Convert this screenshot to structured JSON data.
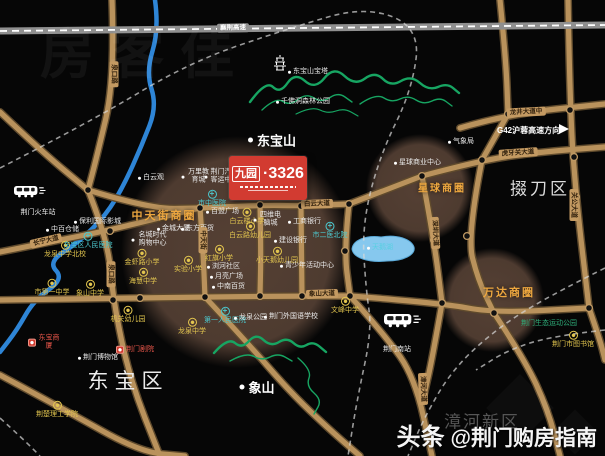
{
  "project": {
    "brand": "九园",
    "number": "·3326"
  },
  "g42": {
    "label": "G42沪蓉高速方向"
  },
  "watermarks": {
    "corner": "房客佳",
    "bottom_prefix": "头条",
    "bottom_handle": "@荆门购房指南"
  },
  "colors": {
    "road": "#b9925c",
    "road_casing": "#5f4a2c",
    "highway": "#8f8f8f",
    "river": "#2e85d6",
    "lake": "#86c8ee",
    "mountain": "#17a562",
    "circle": "#96705a",
    "rail": "#d8d8d8",
    "junction_ring": "#c09a64",
    "school": "#e3c64f",
    "hospital": "#4cc8ce",
    "red": "#e8564a",
    "zone": "#eda73f",
    "green": "#2fae7a",
    "teal": "#58cfe2",
    "badge": "#d23b31"
  },
  "districts": [
    {
      "label": "东宝区",
      "x": 128,
      "y": 380,
      "size": 21,
      "ls": 6,
      "color": "#ececec"
    },
    {
      "label": "掇刀区",
      "x": 540,
      "y": 187,
      "size": 17,
      "ls": 3,
      "color": "#dcdcdc"
    },
    {
      "label": "漳河新区",
      "x": 482,
      "y": 420,
      "size": 17,
      "ls": 2,
      "color": "#565656"
    }
  ],
  "peaks": [
    {
      "label": "东宝山",
      "x": 272,
      "y": 140
    },
    {
      "label": "象山",
      "x": 257,
      "y": 387
    }
  ],
  "zones": [
    {
      "label": "中天街商圈",
      "x": 164,
      "y": 215,
      "size": 11
    },
    {
      "label": "星球商圈",
      "x": 442,
      "y": 187,
      "size": 10
    },
    {
      "label": "万达商圈",
      "x": 509,
      "y": 292,
      "size": 11
    }
  ],
  "road_labels": [
    {
      "label": "襄荆高速",
      "x": 233,
      "y": 28,
      "rot": -1,
      "hw": true
    },
    {
      "label": "泉口路",
      "x": 114,
      "y": 74,
      "rot": 90
    },
    {
      "label": "泉口路",
      "x": 111,
      "y": 274,
      "rot": 90
    },
    {
      "label": "长宁大道",
      "x": 46,
      "y": 241,
      "rot": -13
    },
    {
      "label": "白云大道",
      "x": 317,
      "y": 204,
      "rot": -2
    },
    {
      "label": "中天街",
      "x": 203,
      "y": 240,
      "rot": 90
    },
    {
      "label": "象山大道",
      "x": 322,
      "y": 294,
      "rot": -2
    },
    {
      "label": "龙井大道中",
      "x": 526,
      "y": 112,
      "rot": -3
    },
    {
      "label": "虎牙关大道",
      "x": 518,
      "y": 153,
      "rot": -4
    },
    {
      "label": "关公大道",
      "x": 574,
      "y": 205,
      "rot": 90
    },
    {
      "label": "深圳大道",
      "x": 435,
      "y": 233,
      "rot": 87
    },
    {
      "label": "漳河大道",
      "x": 423,
      "y": 389,
      "rot": 88
    }
  ],
  "pois": [
    {
      "label": "龙泉中学北校",
      "k": "sch",
      "x": 65,
      "y": 250
    },
    {
      "label": "市第一中学",
      "k": "sch",
      "x": 52,
      "y": 288
    },
    {
      "label": "象山中学",
      "k": "sch",
      "x": 90,
      "y": 289
    },
    {
      "label": "金虾路小学",
      "k": "sch",
      "x": 142,
      "y": 258
    },
    {
      "label": "海慧中学",
      "k": "sch",
      "x": 143,
      "y": 277
    },
    {
      "label": "实验小学",
      "k": "sch",
      "x": 188,
      "y": 265
    },
    {
      "label": "红旗小学",
      "k": "sch",
      "x": 219,
      "y": 254
    },
    {
      "label": "白云楼小学",
      "k": "sch",
      "x": 247,
      "y": 217
    },
    {
      "label": "白云路幼儿园",
      "k": "sch",
      "x": 250,
      "y": 231
    },
    {
      "label": "小天鹅幼儿园",
      "k": "sch",
      "x": 277,
      "y": 256
    },
    {
      "label": "机关幼儿园",
      "k": "sch",
      "x": 128,
      "y": 315
    },
    {
      "label": "龙泉中学",
      "k": "sch",
      "x": 192,
      "y": 327
    },
    {
      "label": "文峰中学",
      "k": "sch",
      "x": 345,
      "y": 306
    },
    {
      "label": "荆楚理工学院",
      "k": "sch",
      "x": 57,
      "y": 410
    },
    {
      "label": "荆门市图书馆",
      "k": "sch",
      "x": 573,
      "y": 340
    },
    {
      "label": "东宝区人民医院",
      "k": "hos",
      "x": 88,
      "y": 241
    },
    {
      "label": "市中医院",
      "k": "hos",
      "x": 212,
      "y": 199
    },
    {
      "label": "第一人民医院",
      "k": "hos",
      "x": 225,
      "y": 316
    },
    {
      "label": "市二医北院",
      "k": "hos",
      "x": 330,
      "y": 231
    },
    {
      "label": "中百仓储",
      "k": "wh",
      "x": 46,
      "y": 230
    },
    {
      "label": "保利国际影城",
      "k": "wh",
      "x": 74,
      "y": 222
    },
    {
      "label": "白云观",
      "k": "wh",
      "x": 138,
      "y": 178
    },
    {
      "label": "百盟广场",
      "k": "wh",
      "x": 206,
      "y": 212
    },
    {
      "label": "金城大厦",
      "k": "wh",
      "x": 157,
      "y": 229
    },
    {
      "label": "东方百货",
      "k": "wh",
      "x": 181,
      "y": 229
    },
    {
      "label": "名城时代购物中心",
      "k": "whw",
      "x": 150,
      "y": 240,
      "w": 32
    },
    {
      "label": "万里教育城",
      "k": "whw",
      "x": 196,
      "y": 177,
      "w": 24
    },
    {
      "label": "荆门汽车客运中心",
      "k": "whw",
      "x": 222,
      "y": 177,
      "w": 30
    },
    {
      "label": "四维电脑城",
      "k": "whw",
      "x": 268,
      "y": 220,
      "w": 24
    },
    {
      "label": "工商银行",
      "k": "wh",
      "x": 288,
      "y": 222
    },
    {
      "label": "建设银行",
      "k": "wh",
      "x": 274,
      "y": 241
    },
    {
      "label": "浏河社区",
      "k": "wh",
      "x": 207,
      "y": 267
    },
    {
      "label": "月亮广场",
      "k": "wh",
      "x": 210,
      "y": 277
    },
    {
      "label": "中南百货",
      "k": "wh",
      "x": 212,
      "y": 287
    },
    {
      "label": "青少年活动中心",
      "k": "wh",
      "x": 280,
      "y": 266
    },
    {
      "label": "龙泉公园",
      "k": "wh",
      "x": 234,
      "y": 318
    },
    {
      "label": "荆门外国语学校",
      "k": "wh",
      "x": 264,
      "y": 317
    },
    {
      "label": "荆门博物馆",
      "k": "wh",
      "x": 78,
      "y": 358
    },
    {
      "label": "气象局",
      "k": "wh",
      "x": 448,
      "y": 142
    },
    {
      "label": "星球商业中心",
      "k": "wh",
      "x": 394,
      "y": 163
    },
    {
      "label": "千佛洞森林公园",
      "k": "wh",
      "x": 276,
      "y": 102
    },
    {
      "label": "东宝山宝塔",
      "k": "wh",
      "x": 288,
      "y": 72
    },
    {
      "label": "荆门火车站",
      "k": "whc",
      "x": 38,
      "y": 213
    },
    {
      "label": "荆门南站",
      "k": "whc",
      "x": 397,
      "y": 350
    },
    {
      "label": "东宝商厦",
      "k": "red",
      "x": 28,
      "y": 343,
      "w": 22
    },
    {
      "label": "荆门剧院",
      "k": "red",
      "x": 116,
      "y": 350
    },
    {
      "label": "天鹅湖",
      "k": "teal",
      "x": 367,
      "y": 248
    },
    {
      "label": "荆门生态运动公园",
      "k": "grn",
      "x": 549,
      "y": 324
    }
  ]
}
